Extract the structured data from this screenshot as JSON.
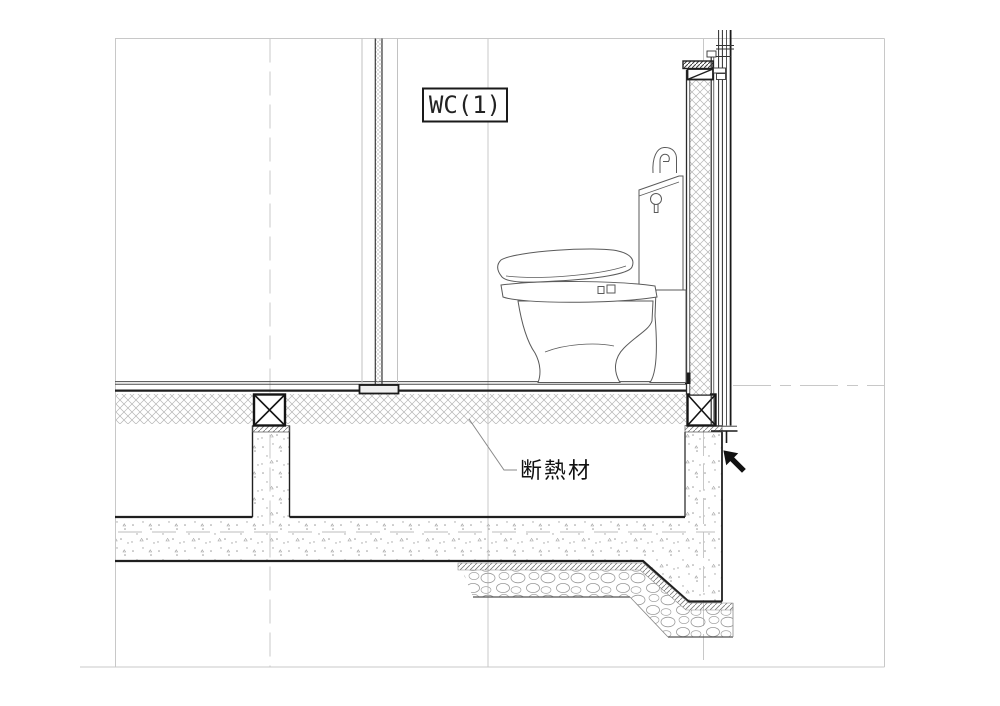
{
  "drawing": {
    "room_label": "WC(1)",
    "annotations": {
      "insulation_label": "断熱材"
    },
    "colors": {
      "background": "#ffffff",
      "line_dark": "#1f1f1f",
      "line_medium": "#555555",
      "grid_light": "#c8c8c8",
      "hatch_light": "#b5b5b5",
      "cursor_black": "#111111"
    }
  }
}
